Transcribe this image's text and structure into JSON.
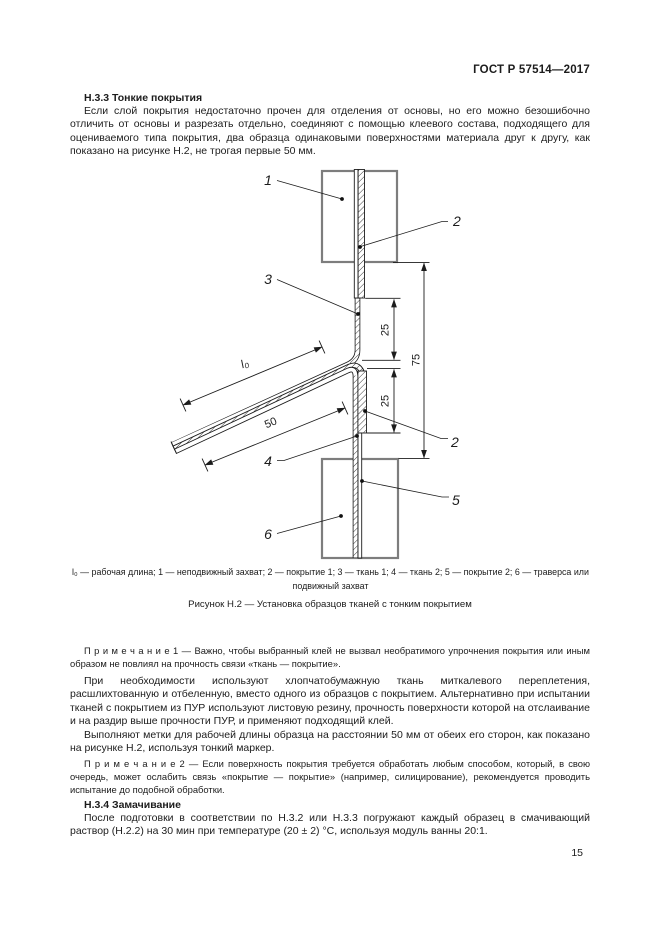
{
  "page": {
    "header": "ГОСТ Р 57514—2017",
    "number": "15"
  },
  "content": {
    "h33_title": "Н.3.3 Тонкие покрытия",
    "h33_para": "Если слой покрытия недостаточно прочен для отделения от основы, но его можно безошибочно отличить от основы и разрезать отдельно, соединяют с помощью клеевого состава, подходящего для оцениваемого типа покрытия, два образца одинаковыми поверхностями материала друг к другу, как показано на рисунке Н.2, не трогая первые 50 мм.",
    "note1": "П р и м е ч а н и е  1 — Важно, чтобы выбранный клей не вызвал необратимого упрочнения покрытия или иным образом не повлиял на прочность связи «ткань — покрытие».",
    "para_fabric": "При необходимости используют хлопчатобумажную ткань миткалевого переплетения, расшлихтованную и отбеленную, вместо одного из образцов с покрытием. Альтернативно при испытании тканей с покрытием из ПУР используют листовую резину, прочность поверхности которой на отслаивание и на раздир выше прочности ПУР, и применяют подходящий клей.",
    "para_marks": "Выполняют метки для рабочей длины образца на расстоянии 50 мм от обеих его сторон, как показано на рисунке Н.2, используя тонкий маркер.",
    "note2": "П р и м е ч а н и е  2 — Если поверхность покрытия требуется обработать любым способом, который, в свою очередь, может ослабить связь «покрытие — покрытие» (например, силицирование), рекомендуется проводить испытание до подобной обработки.",
    "h34_title": "Н.3.4 Замачивание",
    "h34_para": "После подготовки в соответствии по Н.3.2 или Н.3.3 погружают каждый образец в смачивающий раствор (Н.2.2) на 30 мин при температуре (20 ± 2) °С, используя модуль ванны 20:1."
  },
  "figure": {
    "legend": "l₀ — рабочая длина; 1 — неподвижный захват; 2 — покрытие 1; 3 — ткань 1; 4 — ткань 2; 5 — покрытие 2; 6 — траверса или подвижный захват",
    "title": "Рисунок Н.2 — Установка образцов тканей с тонким покрытием",
    "labels": {
      "n1": "1",
      "n2_top": "2",
      "n3": "3",
      "n2_bottom": "2",
      "n4": "4",
      "n5": "5",
      "n6": "6"
    },
    "dims": {
      "top_25": "25",
      "bottom_25": "25",
      "overall_75": "75",
      "glue_50": "50",
      "working_length": "l₀"
    }
  }
}
